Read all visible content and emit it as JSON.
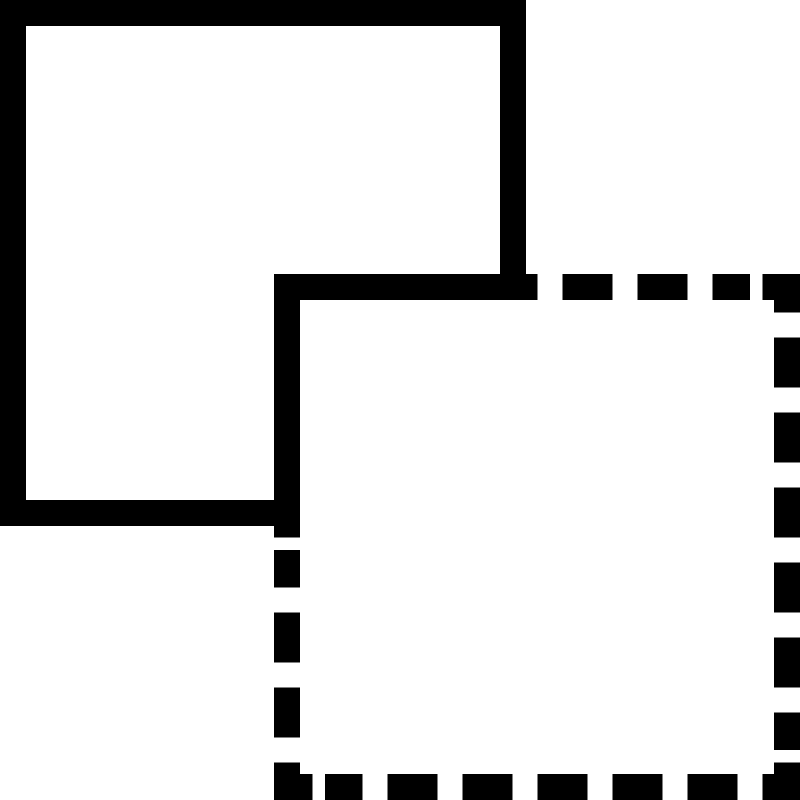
{
  "icon": {
    "name": "overlap-squares",
    "description": "Icon of two overlapping squares: a solid-border square at the top-left sitting behind a dashed-border square at the bottom-right; the dashed square's overlapped top-left corner is drawn with a solid stroke and its bottom-right corner is hidden behind the front square's white fill.",
    "colors": {
      "shape": "#000000",
      "background": "#ffffff"
    },
    "canvas": {
      "width": 800,
      "height": 800
    },
    "stroke_thickness": 26,
    "solid_square": {
      "role": "back-square-solid-border",
      "outer": [
        0,
        0,
        526,
        526
      ],
      "border_rects": [
        {
          "part": "top-bar",
          "rect": [
            0,
            0,
            526,
            26
          ]
        },
        {
          "part": "left-bar",
          "rect": [
            0,
            0,
            26,
            526
          ]
        },
        {
          "part": "right-bar",
          "rect": [
            500,
            0,
            26,
            526
          ]
        },
        {
          "part": "bottom-bar",
          "rect": [
            0,
            500,
            526,
            26
          ]
        }
      ]
    },
    "dashed_square": {
      "role": "front-square-dashed-border",
      "fill_rect": [
        274,
        274,
        526,
        526
      ],
      "border_rects": [
        {
          "part": "overlap-corner-solid-horizontal",
          "rect": [
            274,
            274,
            263.5,
            26
          ]
        },
        {
          "part": "overlap-corner-solid-vertical",
          "rect": [
            274,
            274,
            26,
            263.5
          ]
        },
        {
          "part": "top-dash-1",
          "rect": [
            562.5,
            274,
            50,
            26
          ]
        },
        {
          "part": "top-dash-2",
          "rect": [
            637.5,
            274,
            50,
            26
          ]
        },
        {
          "part": "top-dash-3",
          "rect": [
            712.5,
            274,
            37.5,
            26
          ]
        },
        {
          "part": "top-right-corner-horizontal",
          "rect": [
            762.5,
            274,
            37.5,
            26
          ]
        },
        {
          "part": "top-right-corner-vertical",
          "rect": [
            774,
            274,
            26,
            38.5
          ]
        },
        {
          "part": "right-dash-1",
          "rect": [
            774,
            337.5,
            26,
            50
          ]
        },
        {
          "part": "right-dash-2",
          "rect": [
            774,
            412.5,
            26,
            50
          ]
        },
        {
          "part": "right-dash-3",
          "rect": [
            774,
            487.5,
            26,
            50
          ]
        },
        {
          "part": "right-dash-4",
          "rect": [
            774,
            562.5,
            26,
            50
          ]
        },
        {
          "part": "right-dash-5",
          "rect": [
            774,
            637.5,
            26,
            50
          ]
        },
        {
          "part": "right-dash-6",
          "rect": [
            774,
            712.5,
            26,
            37.5
          ]
        },
        {
          "part": "bottom-right-corner-vertical",
          "rect": [
            774,
            762.5,
            26,
            37.5
          ]
        },
        {
          "part": "bottom-right-corner-horizontal",
          "rect": [
            762.5,
            774,
            37.5,
            26
          ]
        },
        {
          "part": "bottom-dash-1",
          "rect": [
            687.5,
            774,
            50,
            26
          ]
        },
        {
          "part": "bottom-dash-2",
          "rect": [
            612.5,
            774,
            50,
            26
          ]
        },
        {
          "part": "bottom-dash-3",
          "rect": [
            537.5,
            774,
            50,
            26
          ]
        },
        {
          "part": "bottom-dash-4",
          "rect": [
            462.5,
            774,
            50,
            26
          ]
        },
        {
          "part": "bottom-dash-5",
          "rect": [
            387.5,
            774,
            50,
            26
          ]
        },
        {
          "part": "bottom-dash-6",
          "rect": [
            325,
            774,
            37.5,
            26
          ]
        },
        {
          "part": "bottom-left-corner-horizontal",
          "rect": [
            274,
            774,
            38.5,
            26
          ]
        },
        {
          "part": "bottom-left-corner-vertical",
          "rect": [
            274,
            762.5,
            26,
            37.5
          ]
        },
        {
          "part": "left-dash-1",
          "rect": [
            274,
            550,
            26,
            37.5
          ]
        },
        {
          "part": "left-dash-2",
          "rect": [
            274,
            612.5,
            26,
            50
          ]
        },
        {
          "part": "left-dash-3",
          "rect": [
            274,
            687.5,
            26,
            50
          ]
        }
      ]
    }
  }
}
